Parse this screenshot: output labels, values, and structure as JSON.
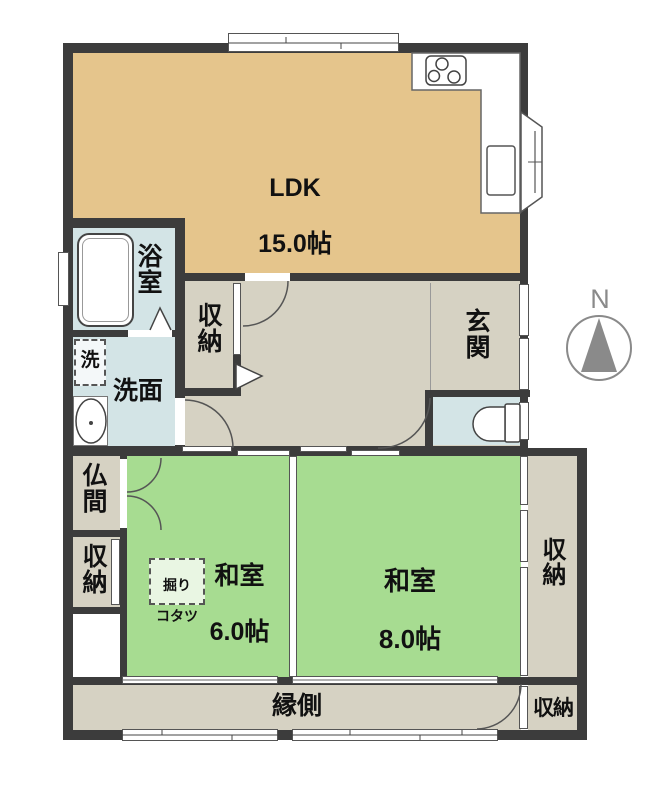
{
  "plan": {
    "type": "apartment-floor-plan",
    "compass_label": "N",
    "colors": {
      "wall": "#3c3c3c",
      "ldk_floor": "#e5c58c",
      "tatami_floor": "#a7dc91",
      "hall_floor": "#d6d2c3",
      "wet_area_floor": "#d3e4e6",
      "fixture_outline": "#444444",
      "compass_gray": "#8a8a8a"
    },
    "rooms": {
      "ldk": {
        "name": "LDK",
        "size": "15.0帖"
      },
      "bath": {
        "name": "浴室"
      },
      "laundry": {
        "name": "洗"
      },
      "washroom": {
        "name": "洗面"
      },
      "hall_storage": {
        "name": "収納"
      },
      "entrance": {
        "name": "玄関"
      },
      "butsuma": {
        "name": "仏間"
      },
      "left_storage": {
        "name": "収納"
      },
      "washitsu6": {
        "name": "和室",
        "size": "6.0帖"
      },
      "kotatsu": {
        "line1": "掘り",
        "line2": "コタツ"
      },
      "washitsu8": {
        "name": "和室",
        "size": "8.0帖"
      },
      "right_storage": {
        "name": "収納"
      },
      "engawa": {
        "name": "縁側"
      },
      "bottom_storage": {
        "name": "収納"
      }
    }
  }
}
